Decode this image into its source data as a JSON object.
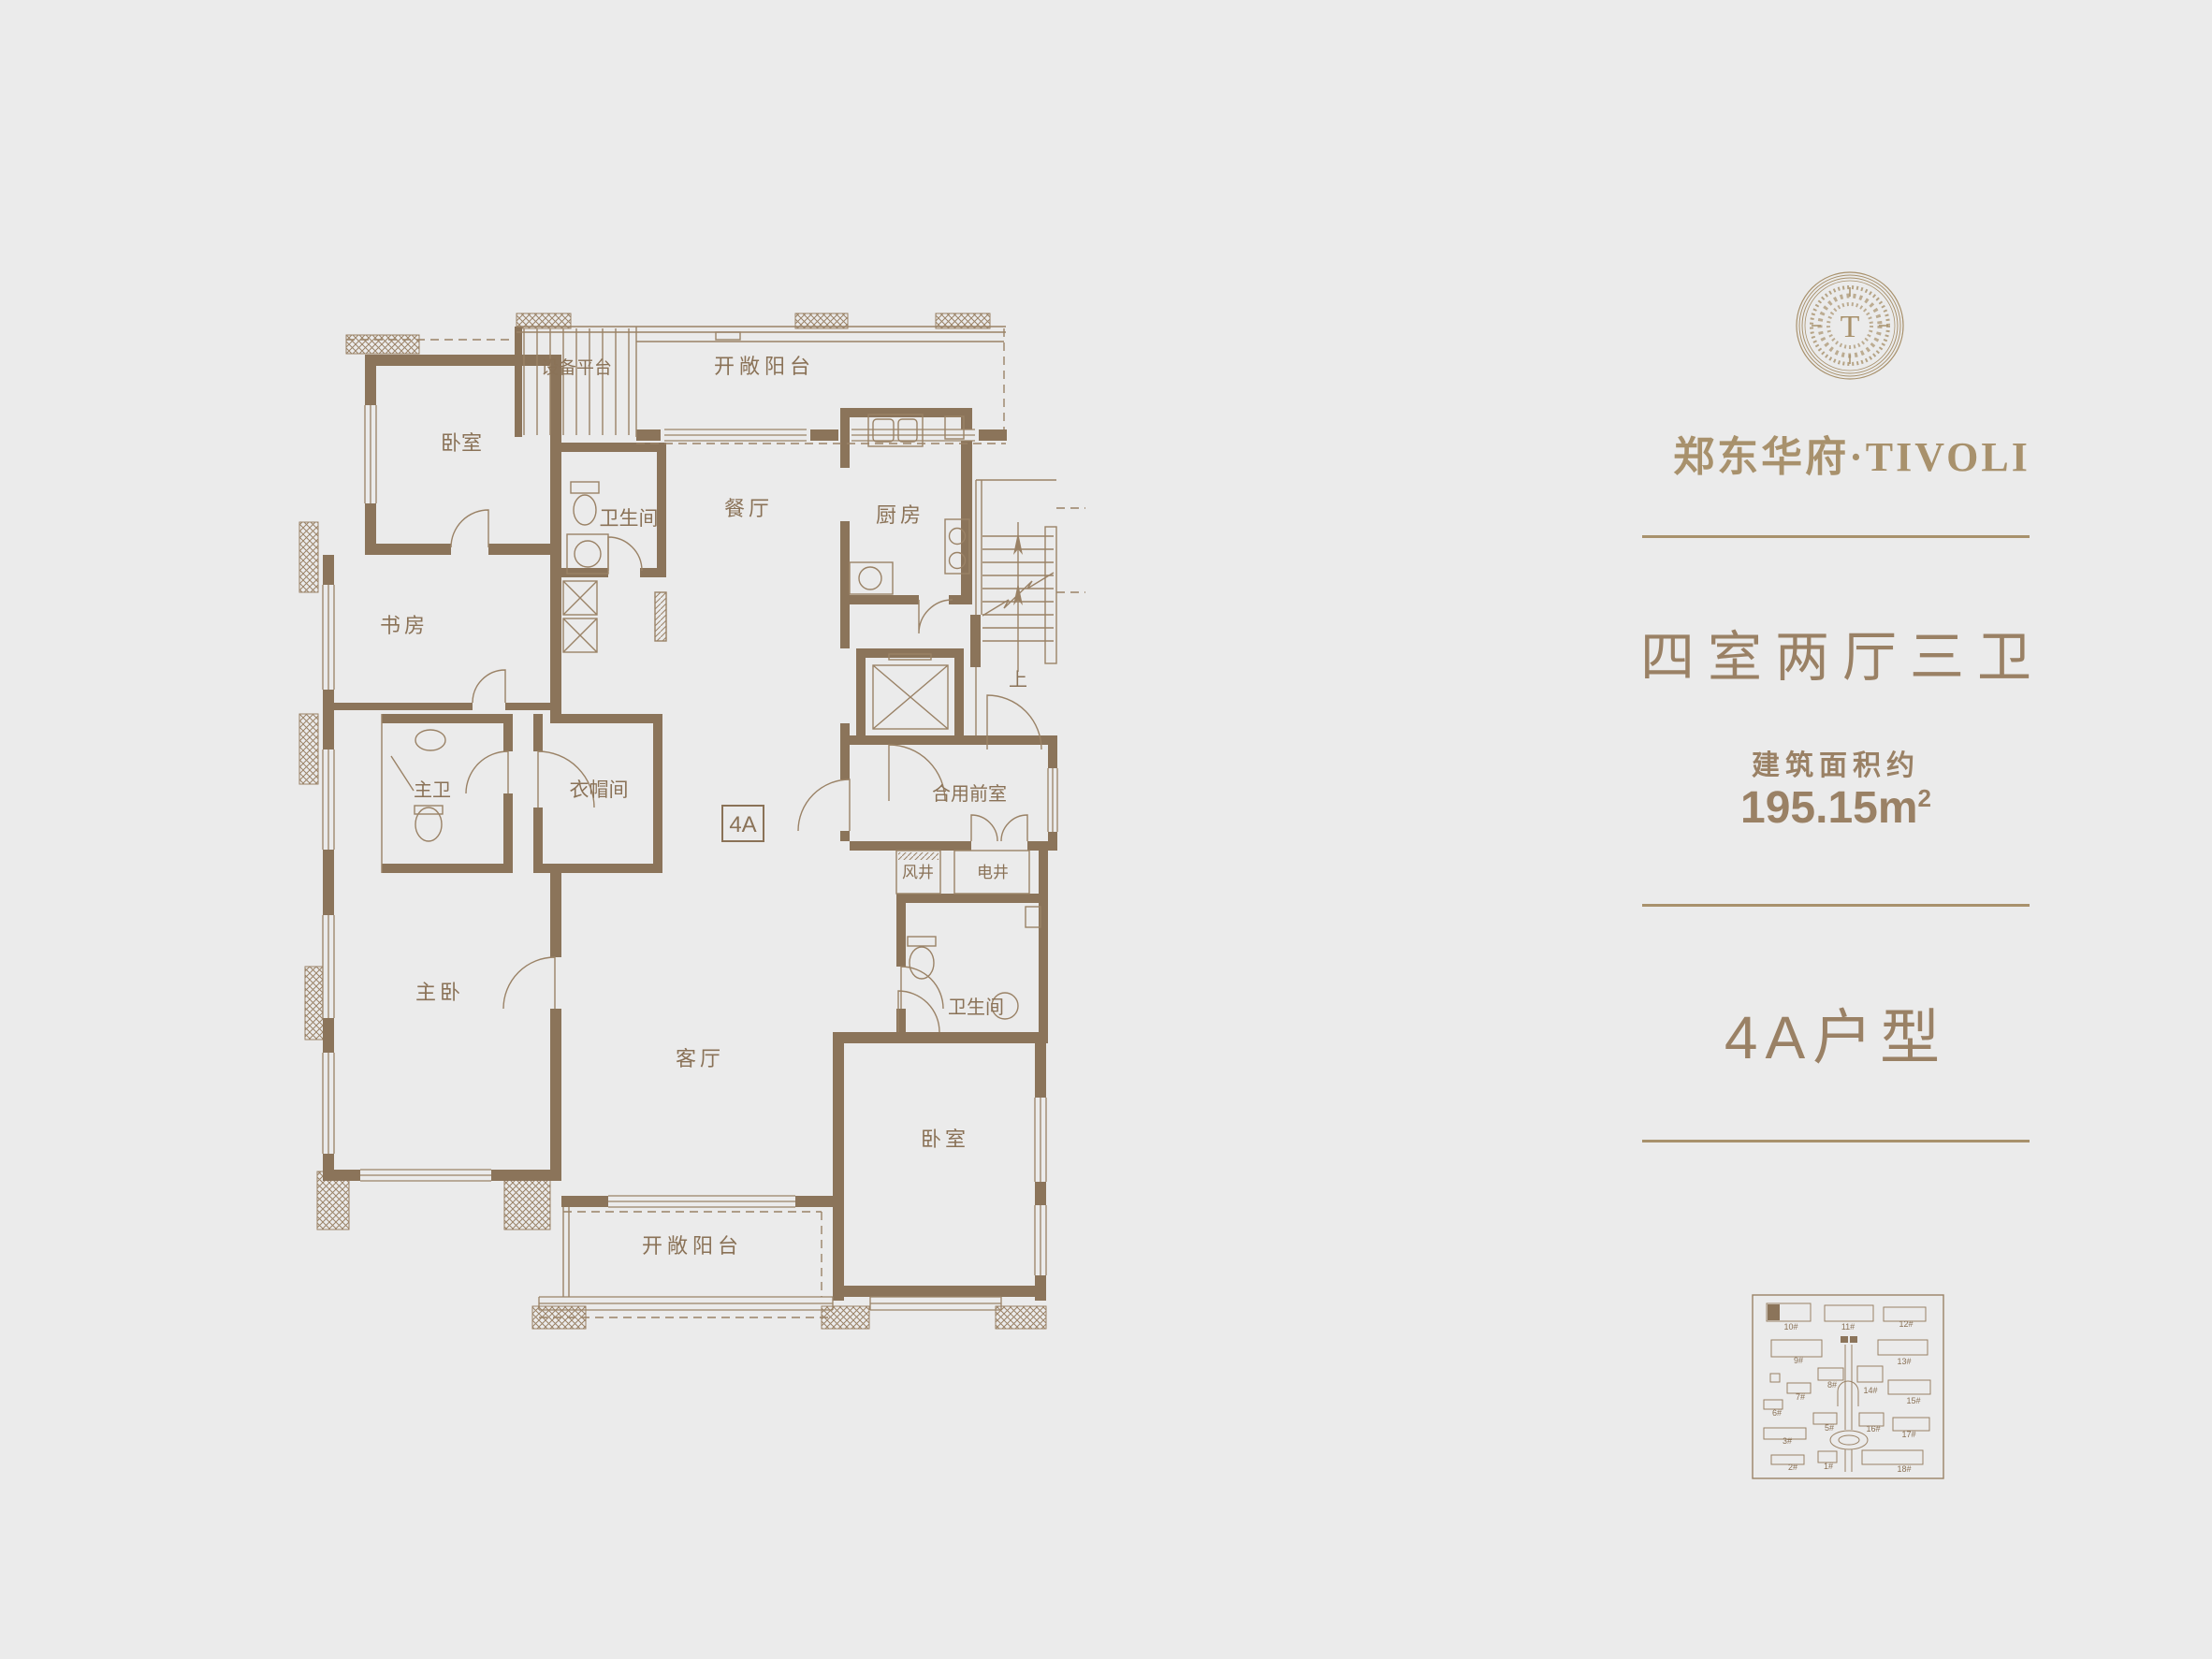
{
  "colors": {
    "background": "#ebebeb",
    "wall": "#8b745a",
    "line": "#9a8266",
    "plan_text": "#8a7257",
    "accent": "#9a8165",
    "brand": "#a8916c"
  },
  "brand": {
    "monogram": "T",
    "name": "郑东华府·TIVOLI"
  },
  "info": {
    "rooms_title": "四室两厅三卫",
    "area_label": "建筑面积约",
    "area_value": "195.15m",
    "area_sup": "2",
    "unit_title": "4A户型"
  },
  "floorplan": {
    "unit_badge": "4A",
    "stairs_up": "上",
    "rooms": [
      {
        "id": "bedroom-top",
        "label": "卧室"
      },
      {
        "id": "equipment-platform",
        "label": "设备平台"
      },
      {
        "id": "open-balcony-top",
        "label": "开敞阳台"
      },
      {
        "id": "bathroom-top",
        "label": "卫生间"
      },
      {
        "id": "dining-room",
        "label": "餐厅"
      },
      {
        "id": "kitchen",
        "label": "厨房"
      },
      {
        "id": "study",
        "label": "书房"
      },
      {
        "id": "master-bathroom",
        "label": "主卫"
      },
      {
        "id": "cloakroom",
        "label": "衣帽间"
      },
      {
        "id": "shared-vestibule",
        "label": "合用前室"
      },
      {
        "id": "wind-shaft",
        "label": "风井"
      },
      {
        "id": "electric-shaft",
        "label": "电井"
      },
      {
        "id": "master-bedroom",
        "label": "主卧"
      },
      {
        "id": "living-room",
        "label": "客厅"
      },
      {
        "id": "bathroom-lower",
        "label": "卫生间"
      },
      {
        "id": "bedroom-lower",
        "label": "卧室"
      },
      {
        "id": "open-balcony-bottom",
        "label": "开敞阳台"
      }
    ]
  },
  "sitemap": {
    "highlighted_building": "10#",
    "buildings": [
      {
        "label": "10#"
      },
      {
        "label": "11#"
      },
      {
        "label": "12#"
      },
      {
        "label": "9#"
      },
      {
        "label": "13#"
      },
      {
        "label": "8#"
      },
      {
        "label": "14#"
      },
      {
        "label": "7#"
      },
      {
        "label": "15#"
      },
      {
        "label": "6#"
      },
      {
        "label": "5#"
      },
      {
        "label": "16#"
      },
      {
        "label": "17#"
      },
      {
        "label": "3#"
      },
      {
        "label": "2#"
      },
      {
        "label": "1#"
      },
      {
        "label": "18#"
      }
    ]
  }
}
